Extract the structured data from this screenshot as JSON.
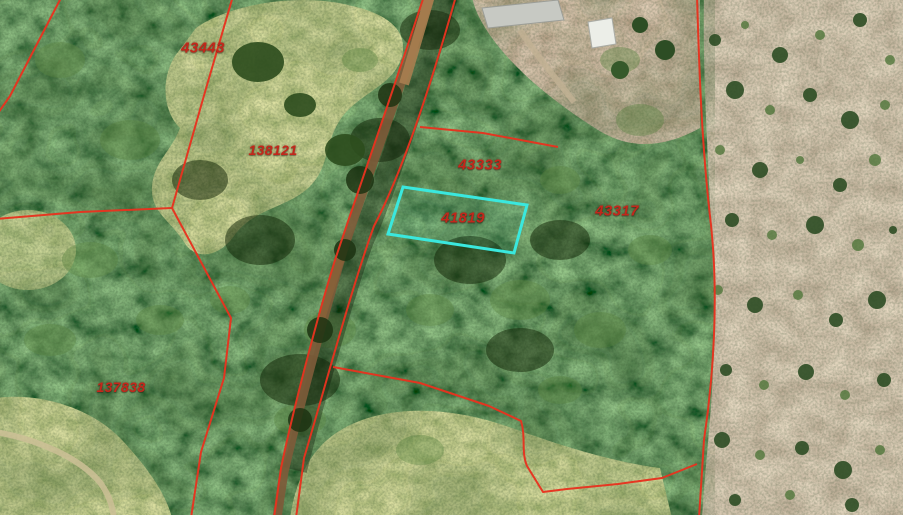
{
  "map": {
    "view": "aerial-parcel-overlay",
    "boundary_color": "#e7331f",
    "label_color": "#c3271b",
    "highlight_color": "#3ae8de",
    "selected_parcel_id": "41819",
    "labels": [
      {
        "id": "43443"
      },
      {
        "id": "138121"
      },
      {
        "id": "43333"
      },
      {
        "id": "41819"
      },
      {
        "id": "43317"
      },
      {
        "id": "137838"
      }
    ]
  }
}
